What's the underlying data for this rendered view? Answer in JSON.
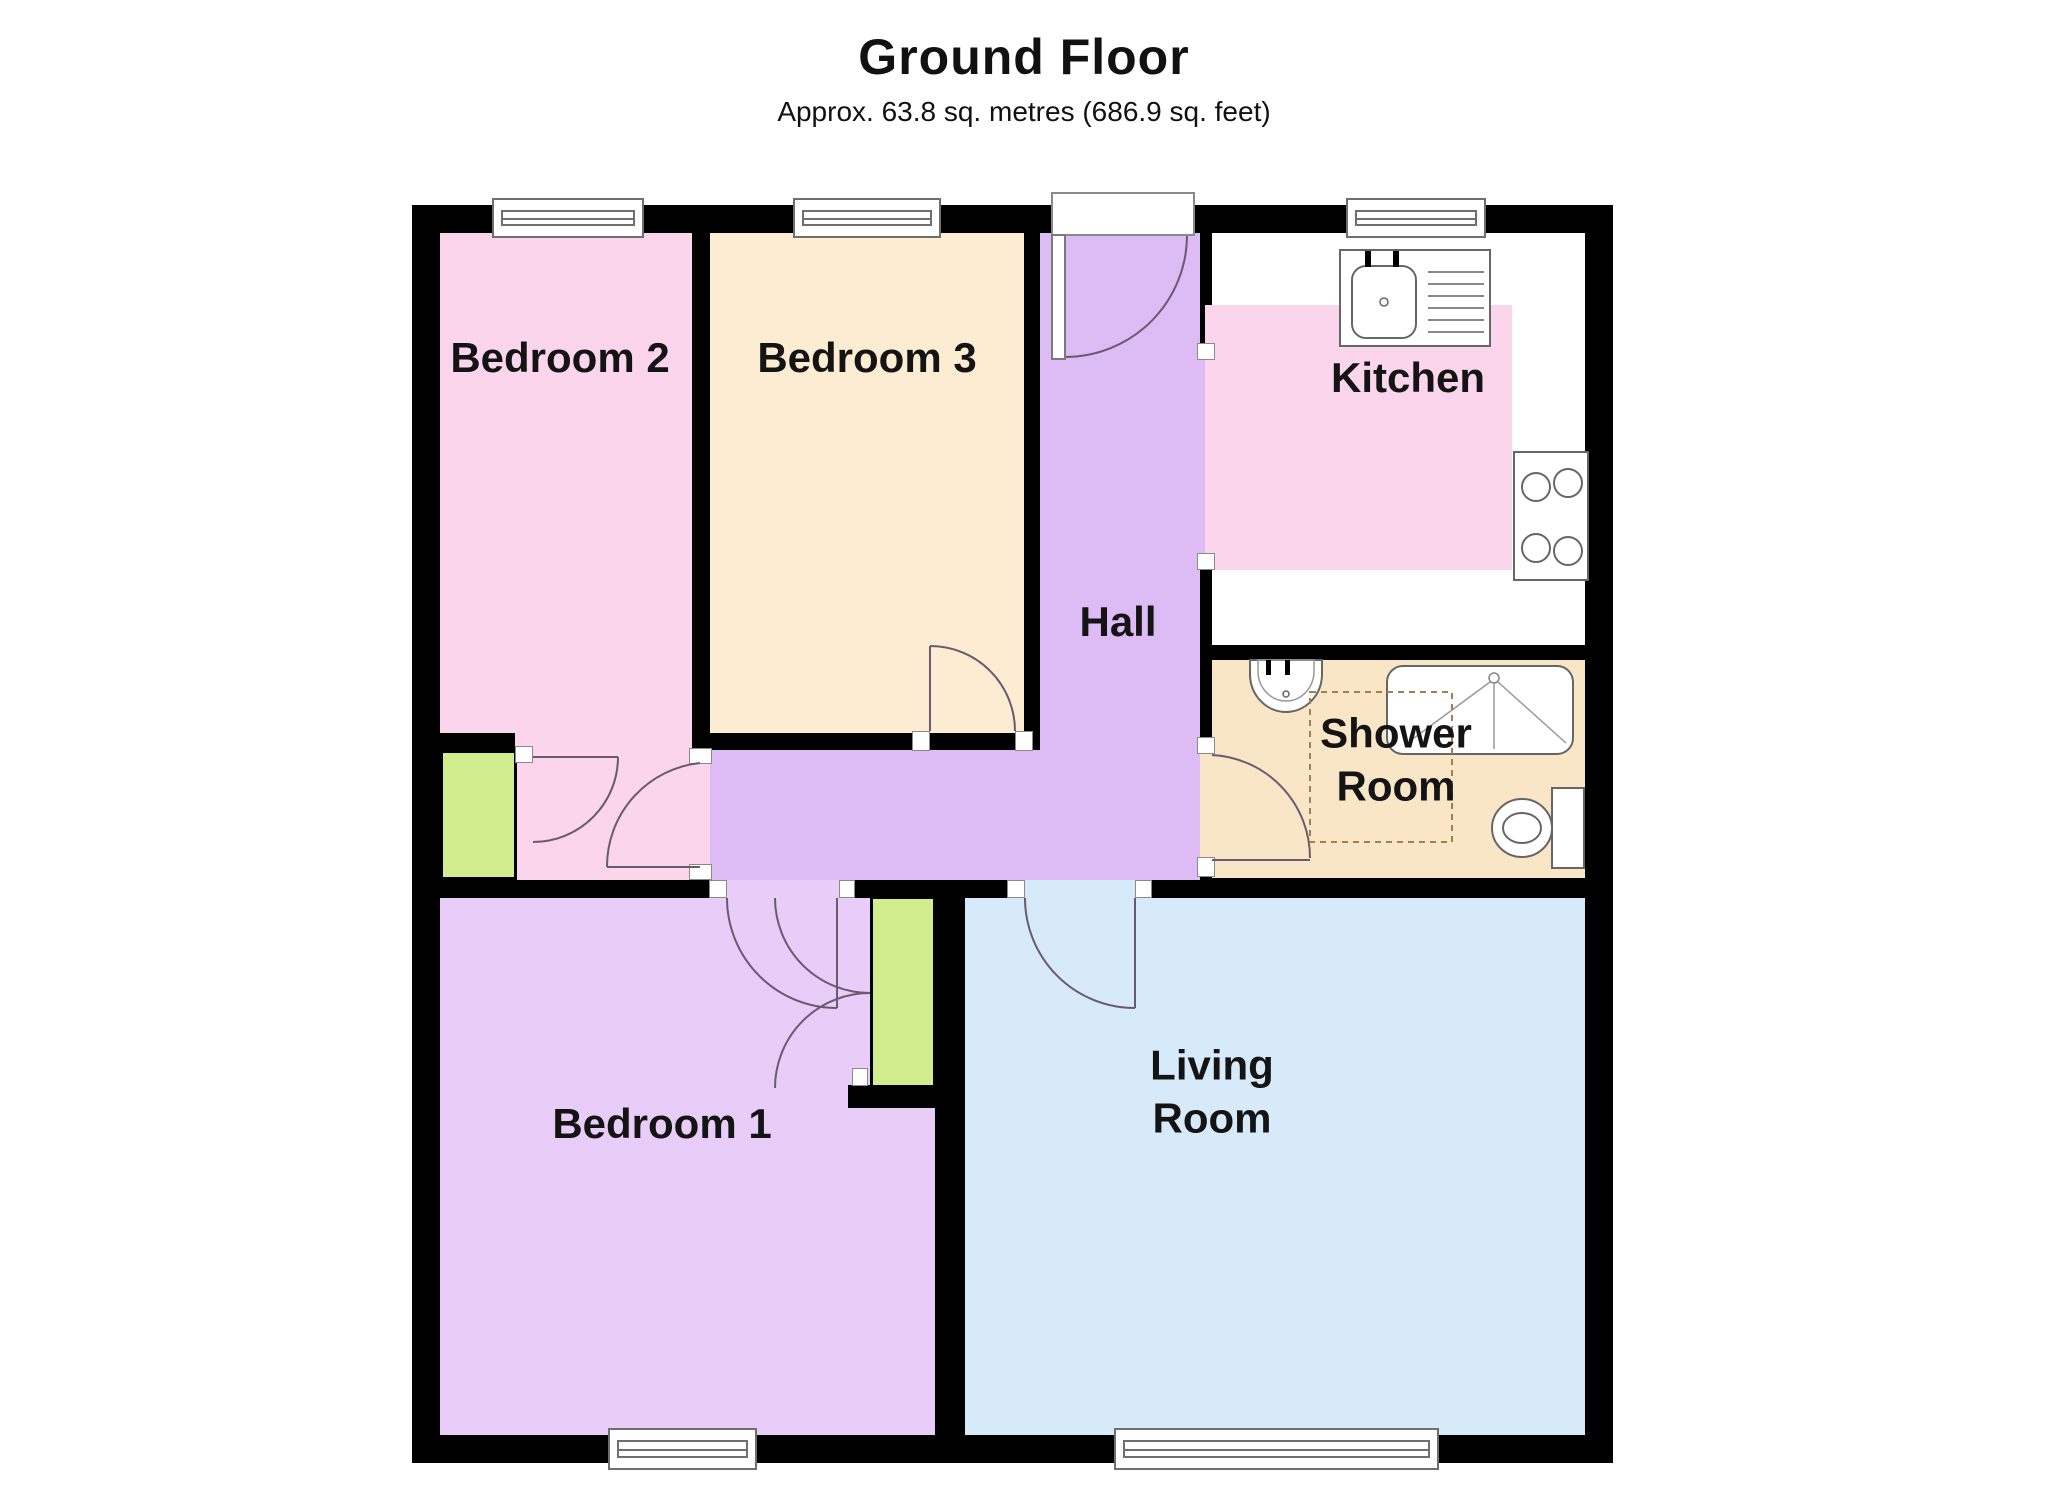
{
  "header": {
    "title": "Ground Floor",
    "subtitle": "Approx. 63.8 sq. metres (686.9 sq. feet)"
  },
  "rooms": {
    "bedroom2": {
      "label": "Bedroom 2"
    },
    "bedroom3": {
      "label": "Bedroom 3"
    },
    "hall": {
      "label": "Hall"
    },
    "kitchen": {
      "label": "Kitchen"
    },
    "shower_room": {
      "label_line1": "Shower",
      "label_line2": "Room"
    },
    "bedroom1": {
      "label": "Bedroom 1"
    },
    "living_room": {
      "label_line1": "Living",
      "label_line2": "Room"
    }
  },
  "fixtures": [
    "kitchen-sink-with-drainer",
    "hob-4-burners",
    "wash-basin",
    "shower-enclosure",
    "toilet",
    "storage-closet-bedroom2",
    "storage-closet-bedroom1",
    "window-bedroom2",
    "window-bedroom3",
    "window-kitchen",
    "window-bedroom1",
    "window-living-room",
    "entry-door",
    "restricted-area-dashed"
  ],
  "colors": {
    "wall": "#000000",
    "pink": "#fbd5ec",
    "cream": "#fcecd2",
    "purple": "#ddbbf5",
    "lilac": "#e7cdf7",
    "blue": "#d7eaf9",
    "green": "#d2ed8d",
    "tan": "#f9e6c6",
    "door": "#6a5a70"
  }
}
